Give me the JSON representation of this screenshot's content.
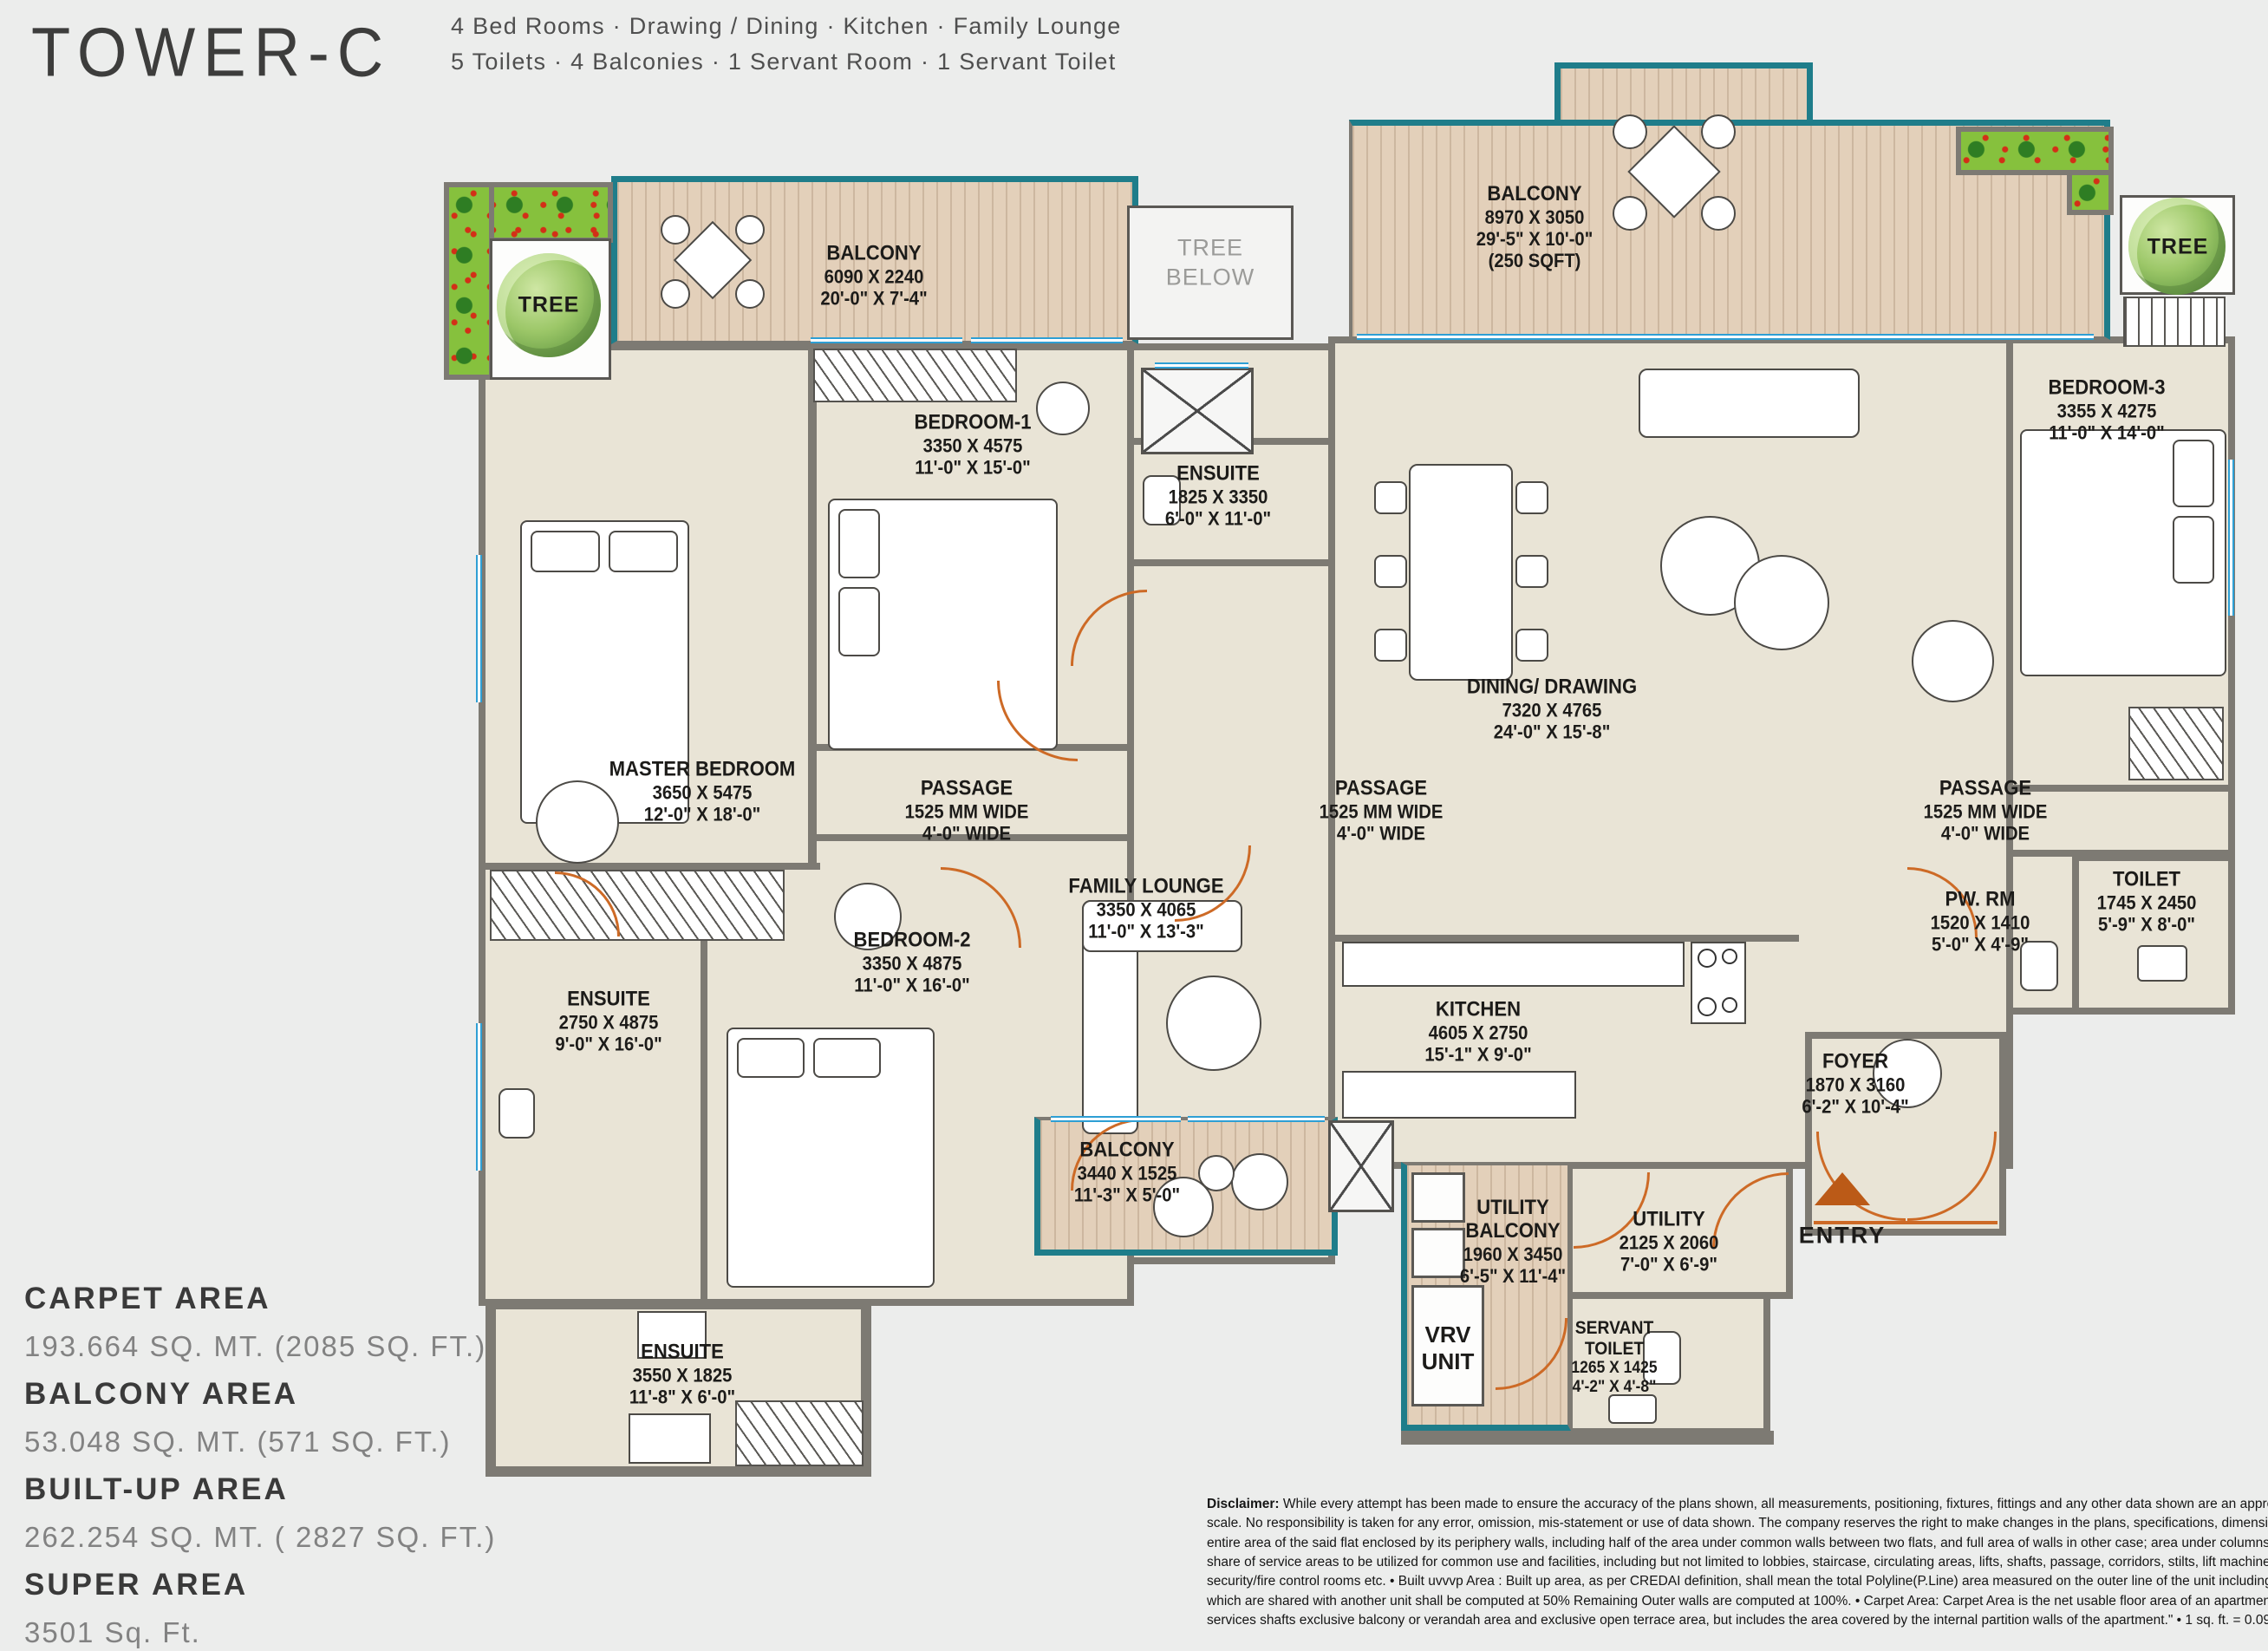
{
  "header": {
    "title": "TOWER-C",
    "subtitle_line1": "4 Bed Rooms · Drawing / Dining · Kitchen · Family Lounge",
    "subtitle_line2": "5 Toilets · 4 Balconies · 1 Servant Room · 1 Servant Toilet"
  },
  "areas": {
    "carpet_label": "CARPET AREA",
    "carpet_value": "193.664 SQ. MT. (2085 SQ. FT.)",
    "balcony_label": "BALCONY AREA",
    "balcony_value": "53.048 SQ. MT. (571 SQ. FT.)",
    "builtup_label": "BUILT-UP AREA",
    "builtup_value": "262.254 SQ. MT. ( 2827 SQ. FT.)",
    "super_label": "SUPER AREA",
    "super_value": "3501 Sq. Ft."
  },
  "rooms": {
    "balcony_tl": {
      "name": "BALCONY",
      "mm": "6090 X 2240",
      "ft": "20'-0\" X 7'-4\""
    },
    "balcony_tr": {
      "name": "BALCONY",
      "mm": "8970 X 3050",
      "ft": "29'-5\" X 10'-0\"",
      "extra": "(250 SQFT)"
    },
    "bedroom1": {
      "name": "BEDROOM-1",
      "mm": "3350 X 4575",
      "ft": "11'-0\" X 15'-0\""
    },
    "ensuite1": {
      "name": "ENSUITE",
      "mm": "1825 X 3350",
      "ft": "6'-0\" X 11'-0\""
    },
    "bedroom3": {
      "name": "BEDROOM-3",
      "mm": "3355 X 4275",
      "ft": "11'-0\" X 14'-0\""
    },
    "master": {
      "name": "MASTER BEDROOM",
      "mm": "3650 X 5475",
      "ft": "12'-0\" X 18'-0\""
    },
    "passage": {
      "name": "PASSAGE",
      "mm": "1525 MM WIDE",
      "ft": "4'-0\" WIDE"
    },
    "dining": {
      "name": "DINING/ DRAWING",
      "mm": "7320 X 4765",
      "ft": "24'-0\" X 15'-8\""
    },
    "family_lounge": {
      "name": "FAMILY LOUNGE",
      "mm": "3350 X 4065",
      "ft": "11'-0\" X 13'-3\""
    },
    "bedroom2": {
      "name": "BEDROOM-2",
      "mm": "3350 X 4875",
      "ft": "11'-0\" X 16'-0\""
    },
    "ensuite2": {
      "name": "ENSUITE",
      "mm": "2750 X 4875",
      "ft": "9'-0\" X 16'-0\""
    },
    "kitchen": {
      "name": "KITCHEN",
      "mm": "4605 X 2750",
      "ft": "15'-1\" X 9'-0\""
    },
    "pw_rm": {
      "name": "PW. RM",
      "mm": "1520 X 1410",
      "ft": "5'-0\" X 4'-9\""
    },
    "toilet": {
      "name": "TOILET",
      "mm": "1745 X 2450",
      "ft": "5'-9\" X 8'-0\""
    },
    "foyer": {
      "name": "FOYER",
      "mm": "1870 X 3160",
      "ft": "6'-2\" X 10'-4\""
    },
    "balcony_bottom": {
      "name": "BALCONY",
      "mm": "3440 X 1525",
      "ft": "11'-3\" X 5'-0\""
    },
    "utility_balcony": {
      "name": "UTILITY\nBALCONY",
      "mm": "1960 X 3450",
      "ft": "6'-5\" X 11'-4\""
    },
    "utility": {
      "name": "UTILITY",
      "mm": "2125 X 2060",
      "ft": "7'-0\" X 6'-9\""
    },
    "servant_toilet": {
      "name": "SERVANT\nTOILET",
      "mm": "1265 X 1425",
      "ft": "4'-2\" X 4'-8\""
    },
    "ensuite3": {
      "name": "ENSUITE",
      "mm": "3550 X 1825",
      "ft": "11'-8\" X 6'-0\""
    }
  },
  "labels": {
    "tree": "TREE",
    "tree_below": "TREE\nBELOW",
    "vrv": "VRV\nUNIT",
    "entry": "ENTRY"
  },
  "colors": {
    "background": "#ecedec",
    "room_fill": "#e9e4d6",
    "wall": "#7d7a73",
    "wood": "#e3d0ba",
    "teal_trim": "#1f7d8a",
    "window_blue": "#2e9fd4",
    "door_orange": "#cd6a26",
    "planter_green": "#86c13d",
    "entry_arrow": "#bb5a17"
  },
  "disclaimer": {
    "bold_prefix": "Disclaimer:",
    "line1_rest": " While every attempt has been made to ensure the accuracy of the plans shown, all measurements, positioning, fixtures, fittings and any other data shown are an approximate interpretation for illustrative purposes",
    "line2": "scale.  No responsibility is taken for any error, omission, mis-statement or use of data shown. The company reserves the right to make changes in the  plans, specifications, dimensions and elevations without any prior notice.",
    "line3": "entire area of the said flat enclosed by its periphery walls, including half of the area under common walls between two flats, and full area of walls in other case; area under columns, cupboards, window projections and balconies",
    "line4": "share of service areas to be utilized for common use and facilities, including but not limited to lobbies, staircase, circulating areas, lifts, shafts, passage, corridors, stilts, lift machine room, area for water supply arrangement",
    "line5": "security/fire control rooms etc. • Built uvvvp Area : Built up area, as per CREDAI definition, shall mean the total Polyline(P.Line) area measured on the outer line of the unit including balconies and /or terrace with or without",
    "line6": "which are shared with another unit shall be computed at 50% Remaining Outer walls are computed at 100%. • Carpet Area: Carpet Area is the net usable floor area of an apartment, excluding the area covered by the external",
    "line7": "services shafts exclusive balcony or verandah area and exclusive open terrace area, but includes the area covered by the internal partition walls of the apartment.\" • 1 sq. ft. = 0.0929 sq. mt., 1 sq. mt. = 10.764 sq. ft, 1 ft. = 0.305 m"
  }
}
